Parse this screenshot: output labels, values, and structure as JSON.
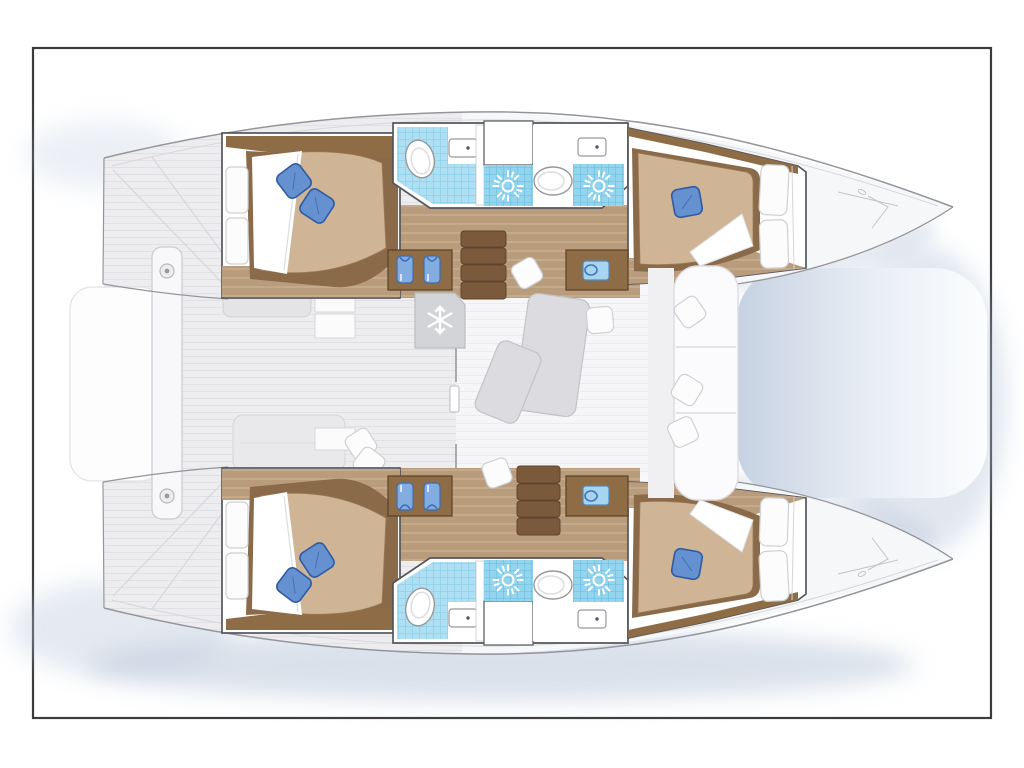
{
  "meta": {
    "title": "Catamaran sailing yacht floor plan — top-down interior layout, 4 cabins / 4 heads",
    "visible_text": []
  },
  "colors": {
    "paper": "#ffffff",
    "frame": "#3c3c3e",
    "hull_fill": "#f2f2f4",
    "bow_fill": "#f6f7f9",
    "hull_edge": "#94959b",
    "hull_edge_light": "#d7d8dc",
    "deck_fill": "#ededf0",
    "plank": "#e1e1e5",
    "shadow": "#b6c4d8",
    "tramp_a": "#c6d2e2",
    "tramp_b": "#e9eef5",
    "tramp_c": "#fcfdfe",
    "wall": "#55565b",
    "room": "#ffffff",
    "floor_wood": "#b89c7c",
    "floor_wood_light": "#cbb394",
    "wood_dark": "#8d6c46",
    "step": "#7b5a3b",
    "step_edge": "#5e442c",
    "mattress": "#cfb595",
    "mattress_edge": "#8a6a48",
    "sheet": "#ffffff",
    "cushion": "#fcfcfd",
    "cushion_edge": "#cfd0d4",
    "pillow_blue": "#6591d1",
    "pillow_blue_edge": "#2f5ba2",
    "tile": "#aedff2",
    "tile_line": "#8fd2ea",
    "shower": "#93d4ee",
    "shower_line": "#74c4e2",
    "fixture": "#ffffff",
    "fixture_edge": "#97989d",
    "cabinet": "#d3d4d7",
    "cabinet_edge": "#bbbcc0",
    "icon_white": "#ffffff",
    "shirt": "#83ade0",
    "shirt_edge": "#3e6db5",
    "sink_blue": "#a8d4f0",
    "sink_blue_edge": "#5588c0",
    "table": "#dcdce0",
    "table_edge": "#c2c3c7",
    "sofa": "#fbfbfd",
    "sofa_edge": "#dcdde1",
    "saloon_floor": "#f6f6f8",
    "saloon_line": "#ececef"
  },
  "vessel": {
    "type": "catamaran",
    "view": "top-down deck plan",
    "hulls": 2,
    "features": {
      "double_cabins": 4,
      "bathrooms": 4,
      "shower_compartments": 4,
      "companionway_stairs": 2,
      "wardrobes_with_shirts": 2,
      "vanity_desks": 2,
      "fridge_freezer": 1,
      "saloon_tables": 2,
      "cockpit_benches": 2,
      "bow_lounge_bench": 1,
      "trampoline": 1,
      "aft_platform": 1
    }
  },
  "icons": [
    {
      "name": "shower-rose-sun-icon",
      "count": 4
    },
    {
      "name": "toilet-icon",
      "count": 4
    },
    {
      "name": "sink-icon",
      "count": 4
    },
    {
      "name": "snowflake-fridge-icon",
      "count": 1
    },
    {
      "name": "hanging-shirt-icon",
      "count": 4
    },
    {
      "name": "blue-pillow-icon",
      "count": 6
    },
    {
      "name": "white-pillow-icon",
      "count": 10
    }
  ]
}
